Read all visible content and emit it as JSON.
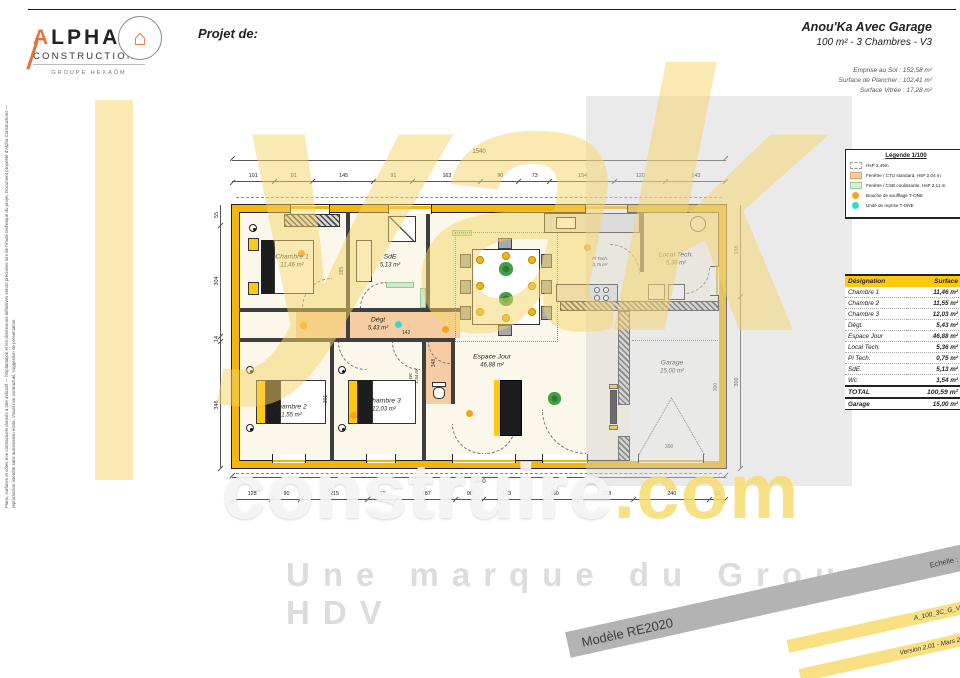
{
  "header": {
    "logo_top": "ALPHA",
    "logo_bottom": "CONSTRUCTIONS",
    "logo_group": "GROUPE HEXAÔM",
    "project_label": "Projet de:",
    "title": "Anou'Ka Avec Garage",
    "subtitle": "100 m² - 3 Chambres - V3",
    "metric_1": "Emprise au Sol : 152,58 m²",
    "metric_2": "Surface de Plancher : 102,41 m²",
    "metric_3": "Surface Vitrée : 17,28 m²"
  },
  "legend": {
    "title": "Légende 1/100",
    "items": [
      {
        "swatch": "dashed-white",
        "label": "HsP 2,49m"
      },
      {
        "swatch": "orange",
        "label": "Fenêtre / CTU standard, HsP 2,04 m"
      },
      {
        "swatch": "green",
        "label": "Fenêtre / CSB coulissante, HsP 2,11 m"
      },
      {
        "swatch": "orange-dot",
        "label": "Bouche de soufflage T-ONE"
      },
      {
        "swatch": "cyan-dot",
        "label": "Unité de reprise T-ONE"
      }
    ]
  },
  "surface_table": {
    "header_designation": "Désignation",
    "header_surface": "Surface",
    "rows": [
      [
        "Chambre 1",
        "11,46 m²"
      ],
      [
        "Chambre 2",
        "11,55 m²"
      ],
      [
        "Chambre 3",
        "12,03 m²"
      ],
      [
        "Dégt.",
        "5,43 m²"
      ],
      [
        "Espace Jour",
        "46,88 m²"
      ],
      [
        "Local Tech.",
        "5,36 m²"
      ],
      [
        "Pl Tech.",
        "0,75 m²"
      ],
      [
        "SdE.",
        "5,13 m²"
      ],
      [
        "Wc",
        "1,54 m²"
      ]
    ],
    "total": [
      "TOTAL",
      "100,59 m²"
    ],
    "garage": [
      "Garage",
      "15,00 m²"
    ]
  },
  "plan": {
    "rooms": {
      "chambre1": {
        "name": "Chambre 1",
        "area": "11,46 m²"
      },
      "sde": {
        "name": "SdE",
        "area": "5,13 m²"
      },
      "degt": {
        "name": "Dégt",
        "area": "5,43 m²"
      },
      "espace_jour": {
        "name": "Espace Jour",
        "area": "46,88 m²"
      },
      "local_tech": {
        "name": "Local Tech.",
        "area": "5,36 m²"
      },
      "pl_tech": {
        "name": "Pl Tech.",
        "area": "0,75 m²"
      },
      "wc": {
        "name": "Wc",
        "area": "1,54 m²"
      },
      "chambre2": {
        "name": "Chambre 2",
        "area": "11,55 m²"
      },
      "chambre3": {
        "name": "Chambre 3",
        "area": "12,03 m²"
      },
      "garage": {
        "name": "Garage",
        "area": "15,00 m²"
      }
    },
    "dims_top_overall": "1540",
    "dims_bottom_overall": "1540",
    "dims_top": [
      "101",
      "91",
      "145",
      "91",
      "163",
      "90",
      "73",
      "154",
      "120",
      "143"
    ],
    "dims_bottom": [
      "128",
      "90",
      "215",
      "90",
      "187",
      "90",
      "143",
      "160",
      "173",
      "240",
      "52"
    ],
    "dims_left": [
      "55",
      "304",
      "14",
      "346"
    ],
    "dims_right": [
      "158",
      "300"
    ],
    "inner_dims": {
      "d1": "385",
      "d2": "301",
      "d3": "142",
      "d4": "348",
      "d5": "300",
      "d6": "300"
    }
  },
  "watermark": {
    "big": "yak",
    "mid_1": "construire",
    "mid_2": ".com",
    "tag": "Une marque du Groupe HDV"
  },
  "footer": {
    "gray_left": "Modèle RE2020",
    "gray_right": "Echelle : 1/75",
    "yellow_1": "A_100_3C_G_V3",
    "yellow_2": "Version 2.01 - Mars 2023"
  },
  "side_note": "Plans, surfaces et côtes non contractuels donnés à titre indicatif — l'implantation et les dimensions définitives seront précisées lors de l'étude technique du projet. Document propriété d'Alpha Constructions — reproduction interdite sans autorisation écrite. Visuel non contractuel, suggestion de présentation."
}
